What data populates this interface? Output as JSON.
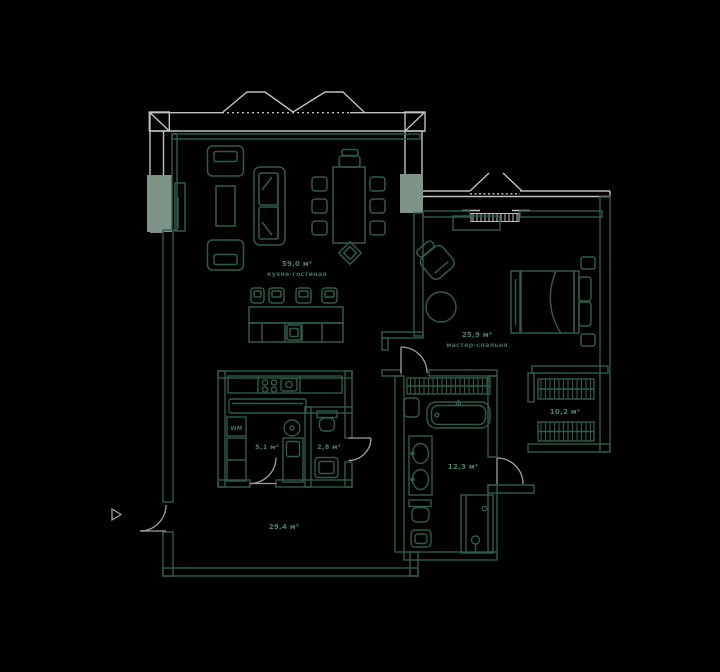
{
  "plan": {
    "type": "apartment-floor-plan",
    "rooms": {
      "living": {
        "area": "59,0 м²",
        "name": "кухня-гостиная"
      },
      "bedroom": {
        "area": "25,9 м²",
        "name": "мастер-спальня"
      },
      "hallway": {
        "area": "29,4 м²"
      },
      "kitchen": {
        "area": "5,1 м²"
      },
      "wc": {
        "area": "2,8 м²"
      },
      "bathroom": {
        "area": "12,3 м²"
      },
      "wardrobe": {
        "area": "10,2 м²"
      }
    },
    "labels": {
      "washing_machine": "WM"
    },
    "colors": {
      "background": "#000000",
      "exterior_wall": "#bcc3c1",
      "interior_wall": "#2e5c4a",
      "pillar": "#7d9488",
      "area_label": "#45826b",
      "name_label": "#3a6e58",
      "door": "#9aa19f"
    }
  }
}
